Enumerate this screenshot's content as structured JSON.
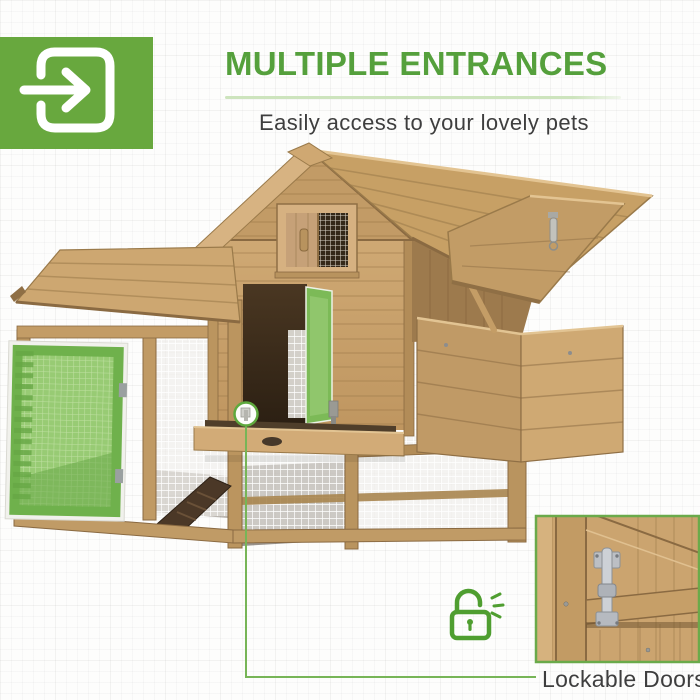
{
  "colors": {
    "brand_green": "#55a03c",
    "badge_green": "#68a83e",
    "underline_green": "#cde4bd",
    "door_highlight_green": "#7cba57",
    "callout_line_green": "#77b557",
    "text_dark": "#3e3e3e"
  },
  "badge": {
    "icon": "enter-door-arrow-icon"
  },
  "heading": {
    "title": "MULTIPLE ENTRANCES",
    "subtitle": "Easily access to your lovely pets"
  },
  "photo": {
    "subject": "wooden chicken coop with mesh run, open nesting-box lid, pull-out tray and ramp",
    "highlighted_parts": [
      "open left mesh door (green)",
      "open house side door (green)"
    ]
  },
  "callout": {
    "label": "Lockable Doors",
    "lock_icon": "open-padlock-icon",
    "inset": "metal door latch close-up"
  }
}
